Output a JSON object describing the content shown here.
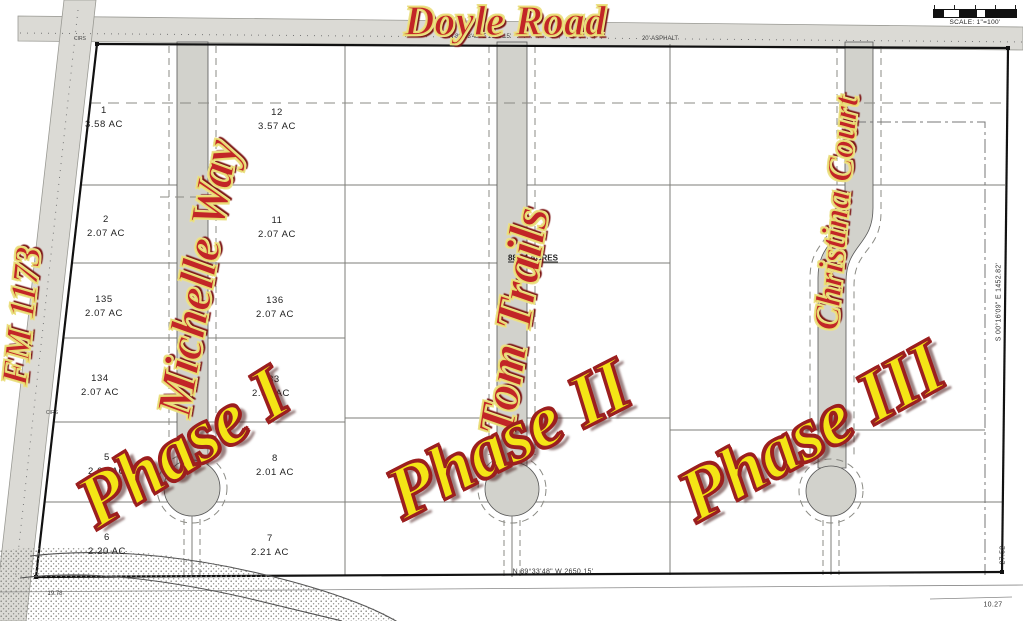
{
  "scale": {
    "label": "SCALE: 1\"=100'"
  },
  "roads": {
    "doyle_road": "Doyle Road",
    "fm_1173": "FM 1173",
    "michelle_way": "Michelle Way",
    "tom_trails": "Tom Trails",
    "christina_court": "Christina Court"
  },
  "phases": {
    "phase1": "Phase I",
    "phase2": "Phase II",
    "phase3": "Phase III"
  },
  "annotations": {
    "total_area": "88.44 ACRES",
    "north_bearing": "N 89°33'48\" E  2649.15'",
    "asphalt_note": "20' ASPHALT",
    "south_bearing": "N 89°33'48\" W  2650.15'",
    "east_bearing": "S 00°16'09\" E  1452.82'",
    "dim_right_vert": "27.52",
    "dim_right_bottom": "10.27",
    "dim_left_bottom": "19.78",
    "marker_top": "CIRS",
    "marker_left": "CIRS"
  },
  "lots": [
    {
      "number": "1",
      "acreage": "3.58 AC",
      "x": 104,
      "y": 118
    },
    {
      "number": "12",
      "acreage": "3.57 AC",
      "x": 277,
      "y": 120
    },
    {
      "number": "2",
      "acreage": "2.07 AC",
      "x": 106,
      "y": 227
    },
    {
      "number": "11",
      "acreage": "2.07 AC",
      "x": 277,
      "y": 228
    },
    {
      "number": "135",
      "acreage": "2.07 AC",
      "x": 104,
      "y": 307
    },
    {
      "number": "136",
      "acreage": "2.07 AC",
      "x": 275,
      "y": 308
    },
    {
      "number": "134",
      "acreage": "2.07 AC",
      "x": 100,
      "y": 386
    },
    {
      "number": "133",
      "acreage": "2.07 AC",
      "x": 271,
      "y": 387
    },
    {
      "number": "5",
      "acreage": "2.07 AC",
      "x": 107,
      "y": 465
    },
    {
      "number": "8",
      "acreage": "2.01 AC",
      "x": 275,
      "y": 466
    },
    {
      "number": "6",
      "acreage": "2.20 AC",
      "x": 107,
      "y": 545
    },
    {
      "number": "7",
      "acreage": "2.21 AC",
      "x": 270,
      "y": 546
    }
  ],
  "colors": {
    "road_fill": "#d2d2cc",
    "label_red": "#c22527",
    "label_yellow": "#f4e516",
    "outline_yellow": "#e8da6e",
    "outline_red": "#9c1f1f"
  }
}
